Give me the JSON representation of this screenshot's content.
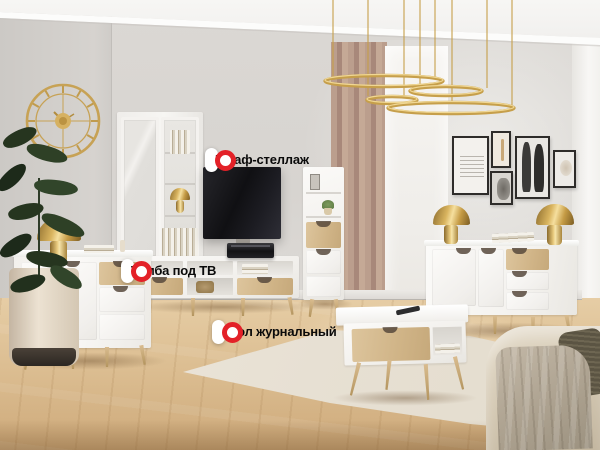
{
  "hotspots": [
    {
      "label": "Шкаф-стеллаж"
    },
    {
      "label": "Тумба под ТВ"
    },
    {
      "label": "Стол журнальный"
    }
  ],
  "colors": {
    "marker_red": "#e32128",
    "gold_accent": "#c9a452",
    "wall_gray": "#d9d6d2",
    "floor_oak": "#dcbe92",
    "rug_cream": "#ebe4d7",
    "furniture_white": "#f7f6f3",
    "wood_accent": "#d3b88c"
  }
}
